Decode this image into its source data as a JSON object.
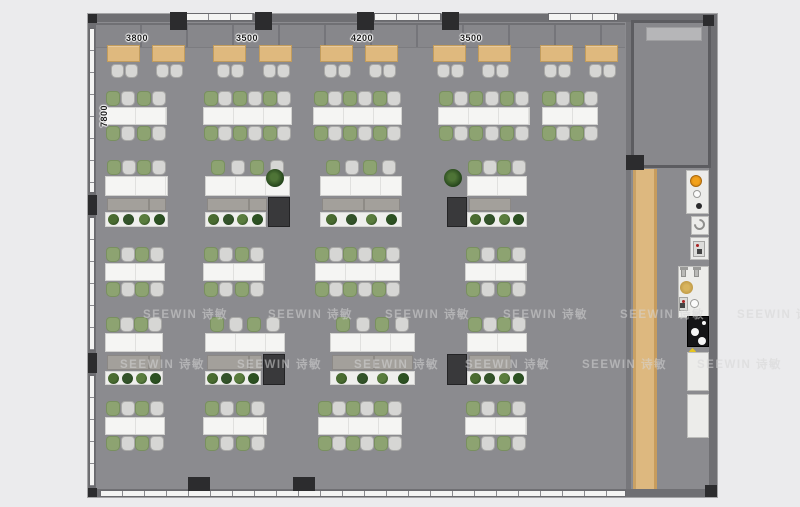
{
  "app": {
    "type": "office floor plan rendering"
  },
  "watermark": {
    "text": "SEEWIN 诗敏",
    "rows": [
      {
        "y": 306,
        "xs": [
          143,
          268,
          385,
          503,
          620,
          737
        ]
      },
      {
        "y": 356,
        "xs": [
          120,
          237,
          354,
          465,
          582,
          697
        ]
      }
    ]
  },
  "dimensions": {
    "top_y": 33,
    "top": [
      {
        "text": "3800",
        "x": 137
      },
      {
        "text": "3500",
        "x": 247
      },
      {
        "text": "4200",
        "x": 362
      },
      {
        "text": "3500",
        "x": 471
      }
    ],
    "left": {
      "text": "7800",
      "x": 104,
      "y": 116
    }
  },
  "colors": {
    "floor": "#8b8b8f",
    "wall": "#6f6f73",
    "wood": "#dfb97e",
    "chair_green": "#8da371",
    "chair_gray": "#d6d6d4",
    "pillar": "#2c2c2e",
    "table": "#f5f5f3",
    "plant_greens": [
      "#4a6c31",
      "#33532a",
      "#5a7d3e",
      "#2c5122"
    ]
  },
  "furniture": {
    "booth_desks": {
      "y": 45,
      "w": 33,
      "h": 17,
      "chairY": 64,
      "xs": [
        107,
        152,
        213,
        259,
        320,
        365,
        433,
        478,
        540,
        585
      ]
    },
    "conference_rows": [
      {
        "chairTop": 91,
        "tableY": 107,
        "tableH": 18,
        "chairBot": 126,
        "tables": [
          {
            "x": 105,
            "w": 62,
            "n": 4
          },
          {
            "x": 203,
            "w": 89,
            "n": 6
          },
          {
            "x": 313,
            "w": 89,
            "n": 6
          },
          {
            "x": 438,
            "w": 92,
            "n": 6
          },
          {
            "x": 542,
            "w": 56,
            "n": 4
          }
        ]
      },
      {
        "chairTop": 247,
        "tableY": 263,
        "tableH": 18,
        "chairBot": 282,
        "tables": [
          {
            "x": 105,
            "w": 60,
            "n": 4
          },
          {
            "x": 203,
            "w": 62,
            "n": 4
          },
          {
            "x": 315,
            "w": 85,
            "n": 6
          },
          {
            "x": 465,
            "w": 62,
            "n": 4
          }
        ]
      },
      {
        "chairTop": 401,
        "tableY": 417,
        "tableH": 18,
        "chairBot": 436,
        "tables": [
          {
            "x": 105,
            "w": 60,
            "n": 4
          },
          {
            "x": 203,
            "w": 64,
            "n": 4
          },
          {
            "x": 318,
            "w": 84,
            "n": 6
          },
          {
            "x": 465,
            "w": 62,
            "n": 4
          }
        ]
      }
    ],
    "desk_rows": [
      {
        "chairY": 160,
        "deskY": 176,
        "deskH": 20,
        "screenY": 198,
        "screenH": 13,
        "planterY": 212,
        "planterH": 15,
        "boxH": 30,
        "clusters": [
          {
            "x": 105,
            "w": 63,
            "n": 4
          },
          {
            "x": 205,
            "w": 85,
            "n": 4,
            "box": "right"
          },
          {
            "x": 320,
            "w": 82,
            "n": 4
          },
          {
            "x": 467,
            "w": 60,
            "n": 4,
            "box": "left"
          }
        ]
      },
      {
        "chairY": 317,
        "deskY": 333,
        "deskH": 19,
        "screenY": 355,
        "screenH": 15,
        "planterY": 371,
        "planterH": 14,
        "boxH": 31,
        "clusters": [
          {
            "x": 105,
            "w": 58,
            "n": 4
          },
          {
            "x": 205,
            "w": 80,
            "n": 4,
            "box": "right"
          },
          {
            "x": 330,
            "w": 85,
            "n": 4
          },
          {
            "x": 467,
            "w": 60,
            "n": 4,
            "box": "left"
          }
        ]
      }
    ],
    "potted_plants": [
      {
        "x": 266,
        "y": 169
      },
      {
        "x": 444,
        "y": 169
      }
    ]
  },
  "structure": {
    "windows": [
      {
        "x": 186,
        "y": 13,
        "w": 68,
        "h": 8,
        "dir": "h"
      },
      {
        "x": 374,
        "y": 13,
        "w": 67,
        "h": 8,
        "dir": "h"
      },
      {
        "x": 548,
        "y": 13,
        "w": 70,
        "h": 8,
        "dir": "h"
      },
      {
        "x": 100,
        "y": 490,
        "w": 526,
        "h": 7,
        "dir": "h"
      },
      {
        "x": 89,
        "y": 28,
        "w": 6,
        "h": 165,
        "dir": "v"
      },
      {
        "x": 89,
        "y": 217,
        "w": 6,
        "h": 134,
        "dir": "v"
      },
      {
        "x": 89,
        "y": 375,
        "w": 6,
        "h": 112,
        "dir": "v"
      }
    ],
    "pillars": [
      {
        "x": 170,
        "y": 12,
        "w": 17,
        "h": 18
      },
      {
        "x": 255,
        "y": 12,
        "w": 17,
        "h": 18
      },
      {
        "x": 357,
        "y": 12,
        "w": 17,
        "h": 18
      },
      {
        "x": 442,
        "y": 12,
        "w": 17,
        "h": 18
      },
      {
        "x": 188,
        "y": 477,
        "w": 22,
        "h": 14
      },
      {
        "x": 293,
        "y": 477,
        "w": 22,
        "h": 14
      },
      {
        "x": 88,
        "y": 195,
        "w": 9,
        "h": 20
      },
      {
        "x": 88,
        "y": 353,
        "w": 9,
        "h": 20
      },
      {
        "x": 626,
        "y": 155,
        "w": 18,
        "h": 15
      },
      {
        "x": 703,
        "y": 15,
        "w": 11,
        "h": 11
      },
      {
        "x": 88,
        "y": 14,
        "w": 9,
        "h": 9
      },
      {
        "x": 705,
        "y": 485,
        "w": 12,
        "h": 12
      },
      {
        "x": 88,
        "y": 488,
        "w": 9,
        "h": 9
      }
    ]
  },
  "kitchen": {
    "fixtures": [
      {
        "t": "panel",
        "x": 686,
        "y": 170,
        "w": 23,
        "h": 44
      },
      {
        "t": "orange",
        "x": 690,
        "y": 175,
        "w": 12,
        "h": 12
      },
      {
        "t": "ring",
        "x": 693,
        "y": 190,
        "w": 8,
        "h": 8
      },
      {
        "t": "dot",
        "x": 696,
        "y": 203,
        "w": 6,
        "h": 6
      },
      {
        "t": "panel",
        "x": 691,
        "y": 216,
        "w": 18,
        "h": 19
      },
      {
        "t": "arc",
        "x": 694,
        "y": 219,
        "w": 11,
        "h": 11
      },
      {
        "t": "panel",
        "x": 690,
        "y": 237,
        "w": 19,
        "h": 23
      },
      {
        "t": "mini",
        "x": 693,
        "y": 241,
        "w": 12,
        "h": 16
      },
      {
        "t": "panel",
        "x": 678,
        "y": 266,
        "w": 31,
        "h": 52
      },
      {
        "t": "faucet",
        "x": 681,
        "y": 268,
        "w": 5,
        "h": 9
      },
      {
        "t": "faucet",
        "x": 694,
        "y": 268,
        "w": 5,
        "h": 9
      },
      {
        "t": "gold",
        "x": 680,
        "y": 281,
        "w": 13,
        "h": 13
      },
      {
        "t": "ring",
        "x": 690,
        "y": 299,
        "w": 9,
        "h": 9
      },
      {
        "t": "mini",
        "x": 679,
        "y": 297,
        "w": 9,
        "h": 14
      },
      {
        "t": "cook",
        "x": 687,
        "y": 316,
        "w": 22,
        "h": 31
      },
      {
        "t": "warn",
        "x": 690,
        "y": 349,
        "w": 5,
        "h": 5
      },
      {
        "t": "panel",
        "x": 687,
        "y": 352,
        "w": 22,
        "h": 39
      },
      {
        "t": "panel",
        "x": 687,
        "y": 394,
        "w": 22,
        "h": 44
      }
    ]
  }
}
